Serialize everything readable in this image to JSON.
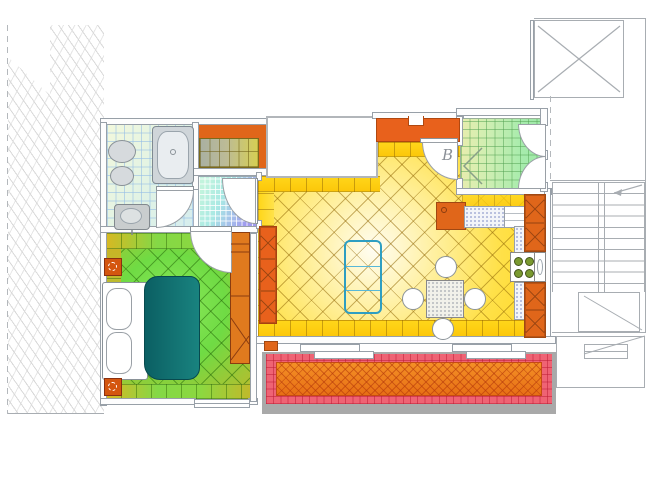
{
  "title": "apartment-floor-plan",
  "labels": {
    "door_b": "B"
  },
  "palette": {
    "wall_line": "#98a0a8",
    "orange_furniture": "#e0661a",
    "orange_dark": "#a04812",
    "living_floor_yellow": "#ffd415",
    "bedroom_floor_green": "#6fdb44",
    "bed_duvet_teal": "#117d79",
    "coffee_table_cyan": "#aee4f6",
    "balcony_border_pink": "#ef6374",
    "balcony_deck_orange": "#ee7d1c",
    "balcony_rim_gray": "#a9a9a9",
    "entry_tile_green": "#a6ebac",
    "hallway_tile_teal": "#a9e9e4",
    "hallway_tile_purple": "#a09aef",
    "bathroom_tile": "#dff2e6",
    "closet_tile_yellow": "#d6cf52",
    "counter_speckle": "#f3f5f9"
  },
  "rooms": [
    {
      "name": "bathroom",
      "fill": "#dff2e6"
    },
    {
      "name": "closet",
      "fill": "#e0661a"
    },
    {
      "name": "hallway",
      "fill": "#a9e9e4"
    },
    {
      "name": "bedroom",
      "fill": "#6fdb44"
    },
    {
      "name": "living-room",
      "fill": "#ffd415"
    },
    {
      "name": "kitchen",
      "fill": "#ffe14a"
    },
    {
      "name": "entry",
      "fill": "#a6ebac"
    },
    {
      "name": "balcony",
      "fill": "#ee7d1c"
    },
    {
      "name": "staircase",
      "fill": "#ffffff"
    },
    {
      "name": "elevator",
      "fill": "#ffffff"
    }
  ]
}
